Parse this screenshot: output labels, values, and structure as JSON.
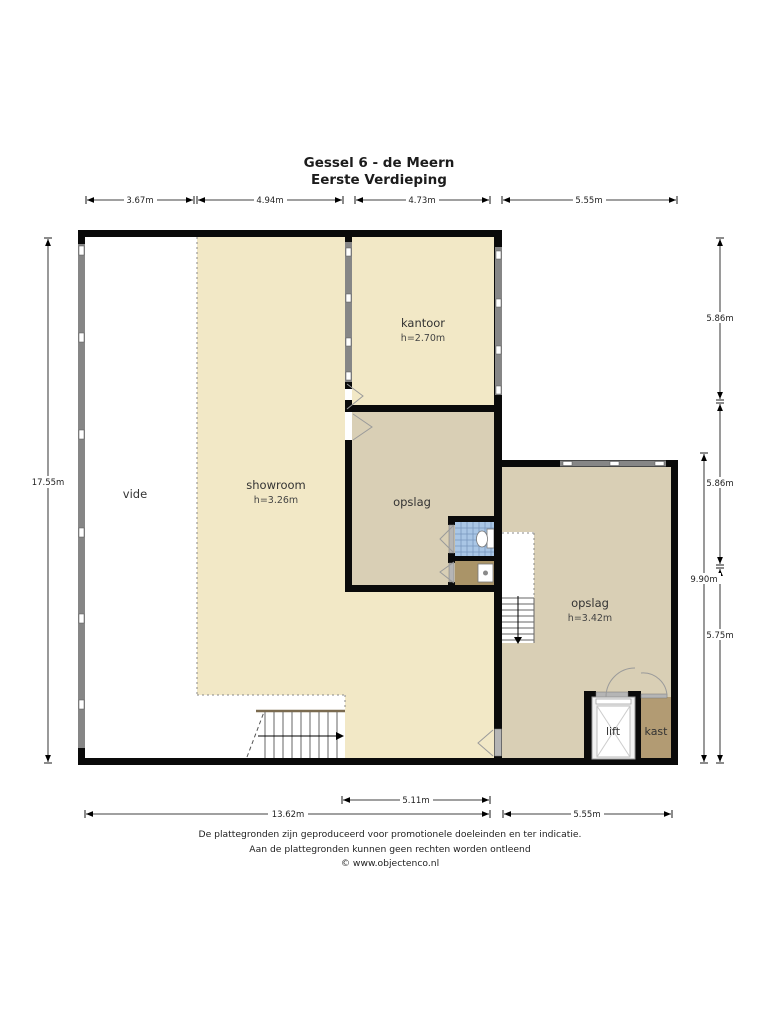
{
  "title": {
    "line1": "Gessel 6 - de Meern",
    "line2": "Eerste Verdieping"
  },
  "dimensions": {
    "top": [
      "3.67m",
      "4.94m",
      "4.73m",
      "5.55m"
    ],
    "left": [
      "17.55m"
    ],
    "right": [
      "5.86m",
      "5.86m",
      "9.90m",
      "5.75m"
    ],
    "bottom": [
      "5.11m",
      "13.62m",
      "5.55m"
    ]
  },
  "rooms": {
    "vide": {
      "label": "vide"
    },
    "showroom": {
      "label": "showroom",
      "height": "h=3.26m"
    },
    "kantoor": {
      "label": "kantoor",
      "height": "h=2.70m"
    },
    "opslag_middle": {
      "label": "opslag"
    },
    "opslag_right": {
      "label": "opslag",
      "height": "h=3.42m"
    },
    "lift": {
      "label": "lift"
    },
    "kast": {
      "label": "kast"
    }
  },
  "footer": {
    "line1": "De plattegronden zijn geproduceerd voor promotionele doeleinden en ter indicatie.",
    "line2": "Aan de plattegronden kunnen geen rechten worden ontleend",
    "line3": "© www.objectenco.nl"
  },
  "colors": {
    "floor_light": "#f2e8c6",
    "floor_tan": "#d9cfb5",
    "closet_brown": "#b29b73",
    "washroom_brown": "#aa9468",
    "tile_blue": "#a9c6e5",
    "wall_black": "#0a0a0a",
    "window_gray": "#868686"
  }
}
